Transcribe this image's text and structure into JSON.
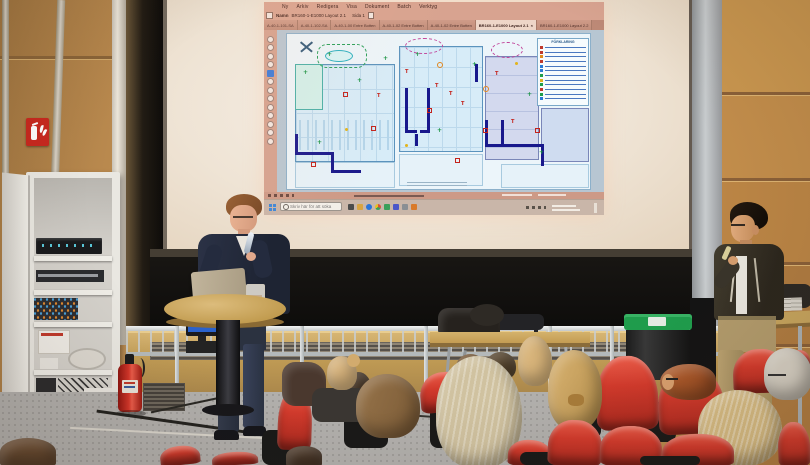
{
  "screen_ui": {
    "menu": [
      "Ny",
      "Arkiv",
      "Redigera",
      "Visa",
      "Dokument",
      "Batch",
      "Verktyg"
    ],
    "doc_label": "Namn",
    "doc_name": "BR160-1-E1000 Layout 2.1",
    "page_indicator": "Sida 1",
    "tabs": [
      "A-40-1-101-SA",
      "A-40-1-102-SA",
      "A-40-1-00 Entre Botten",
      "A-40-1-02 Entre Botten",
      "A-40-1-02 Entre Botten",
      "BR160-1-E1000 Layout 2.1",
      "BR160-1-E1000 Layout 2.2"
    ],
    "active_tab_index": 5,
    "tab_close": "×",
    "search_placeholder": "Skriv här för att söka",
    "legend_title": "FÖRKLARING",
    "legend_colors": [
      "#c0392b",
      "#c0392b",
      "#e08a1e",
      "#c0392b",
      "#2a7ad4",
      "#2a7ad4",
      "#1e9e4a",
      "#e0b020",
      "#1e9e4a",
      "#c0392b",
      "#1e9e4a",
      "#2a7ad4"
    ]
  },
  "colors": {
    "seat_red": "#d0362b",
    "wall_wood": "#b98a4e",
    "bin_lid_green": "#1e9b4b",
    "extinguisher_red": "#c8231d",
    "plan_wall_blue": "#5b93bd",
    "plan_route_navy": "#18188c",
    "screen_chrome_pink": "#d6a28e",
    "taskbar_gray": "#c9b6a9"
  },
  "icons": {
    "fire_extinguisher_sign": "white extinguisher + flames pictogram on red square",
    "windows_start": "four-pane window glyph",
    "search": "magnifier glyph"
  }
}
